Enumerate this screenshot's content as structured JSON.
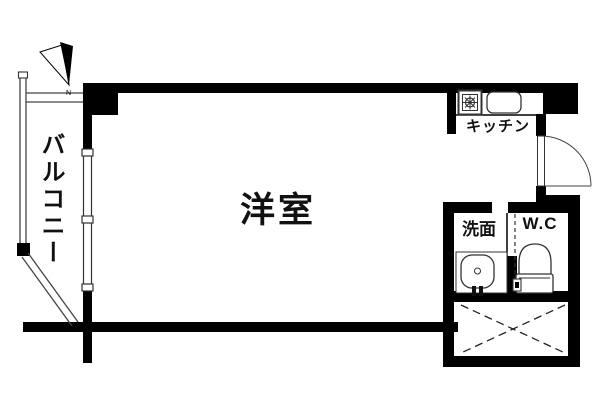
{
  "rooms": {
    "main": {
      "label": "洋室"
    },
    "balcony": {
      "label": "バルコニー"
    },
    "kitchen": {
      "label": "キッチン"
    },
    "washroom": {
      "label": "洗面"
    },
    "toilet": {
      "label": "W.C"
    }
  },
  "compass": {
    "label": "N"
  },
  "colors": {
    "wall": "#000000",
    "fixture_outline": "#333333",
    "thin_line": "#444444",
    "background": "#ffffff"
  }
}
